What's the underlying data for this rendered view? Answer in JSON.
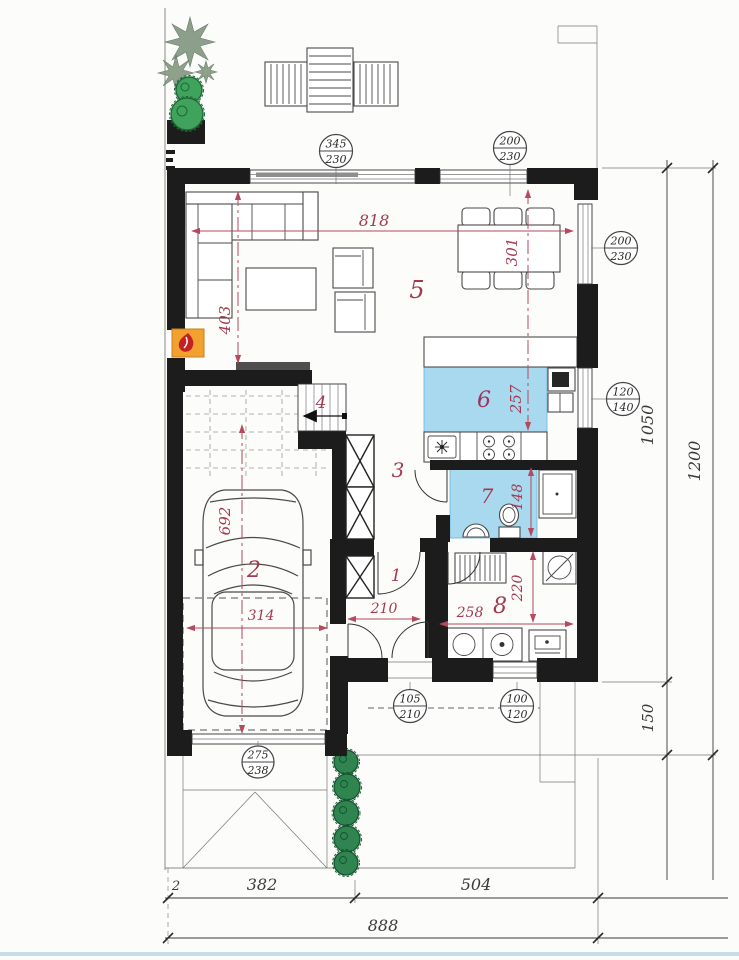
{
  "rooms": {
    "entry": "1",
    "garage": "2",
    "hall": "3",
    "stairs": "4",
    "living": "5",
    "kitchen": "6",
    "bath": "7",
    "utility": "8"
  },
  "red_dims": {
    "living_width": "818",
    "dining_depth": "301",
    "living_depth": "403",
    "kitchen_depth": "257",
    "bath_depth": "148",
    "garage_length": "692",
    "garage_width": "314",
    "entry_width": "210",
    "utility_width": "258",
    "utility_depth": "220"
  },
  "openings": {
    "slider": {
      "w": "345",
      "h": "230"
    },
    "win_top": {
      "w": "200",
      "h": "230"
    },
    "win_right": {
      "w": "200",
      "h": "230"
    },
    "win_kitchen": {
      "w": "120",
      "h": "140"
    },
    "door_entry": {
      "w": "105",
      "h": "210"
    },
    "win_utility": {
      "w": "100",
      "h": "120"
    },
    "garage_door": {
      "w": "275",
      "h": "238"
    }
  },
  "site_dims": {
    "main_height": "1050",
    "porch_height": "150",
    "total_height": "1200",
    "offset": "2",
    "garage_span": "382",
    "house_span": "504",
    "total_width": "888"
  },
  "colors": {
    "wall": "#1c1c1c",
    "dim_red": "#a23a50",
    "floor_blue": "#a8d9ee",
    "bush_green": "#2f8450",
    "fireplace_orange": "#f2a12f"
  }
}
